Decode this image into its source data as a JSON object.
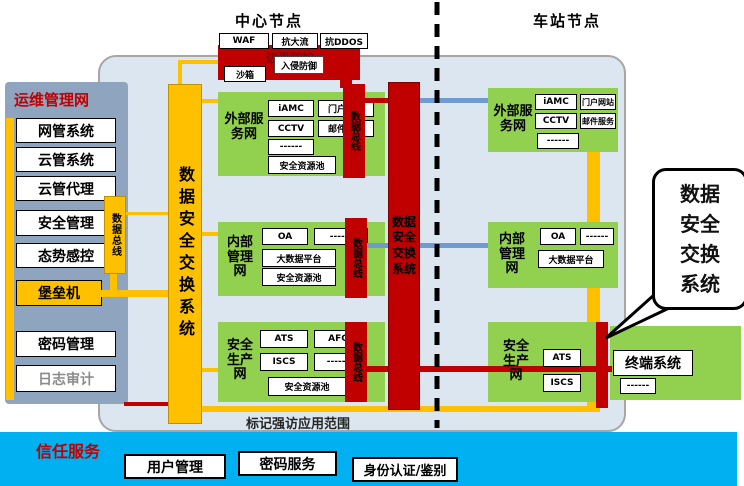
{
  "top_labels": {
    "center": "中心节点",
    "station": "车站节点"
  },
  "border_security": {
    "top_boxes": [
      "WAF",
      "抗大流",
      "抗DDOS"
    ],
    "body": "边界防护",
    "overlay": "入侵防御",
    "sandbox": "沙箱"
  },
  "ops_network": {
    "title": "运维管理网",
    "items": [
      "网管系统",
      "云管系统",
      "云管代理",
      "安全管理",
      "态势感控",
      "堡垒机",
      "密码管理",
      "日志审计"
    ],
    "bus_tab": "数据总线"
  },
  "exchange_bar_label": "数据安全交换系统",
  "data_bus_label": "数据总线",
  "central_exchange_label": "数据安全交换系统",
  "center_networks": [
    {
      "name": "外部服务网",
      "boxes": [
        "iAMC",
        "门户网站",
        "CCTV",
        "邮件服务",
        "------"
      ],
      "pool": "安全资源池"
    },
    {
      "name": "内部管理网",
      "boxes": [
        "OA",
        "------",
        "大数据平台"
      ],
      "pool": "安全资源池"
    },
    {
      "name": "安全生产网",
      "boxes": [
        "ATS",
        "AFC",
        "ISCS",
        "------"
      ],
      "pool": "安全资源池"
    }
  ],
  "station_networks": [
    {
      "name": "外部服务网",
      "boxes": [
        "iAMC",
        "门户网站",
        "CCTV",
        "邮件服务",
        "------"
      ]
    },
    {
      "name": "内部管理网",
      "boxes": [
        "OA",
        "------",
        "大数据平台"
      ]
    },
    {
      "name": "安全生产网",
      "boxes": [
        "ATS",
        "ISCS"
      ]
    }
  ],
  "terminal_system": {
    "name": "终端系统",
    "box": "------"
  },
  "callout_label": "数据安全交换系统",
  "scope_note": "标记强访应用范围",
  "trust_services": {
    "title": "信任服务",
    "boxes": [
      "用户管理",
      "密码服务",
      "身份认证/鉴别"
    ]
  },
  "colors": {
    "yellow": "#FFC000",
    "red": "#C00000",
    "green": "#92D050",
    "cyan": "#00B0F0",
    "sidebar_blue": "#8FA5BF",
    "container_bg": "#DCE6F1",
    "line_blue": "#6E9CD2"
  }
}
